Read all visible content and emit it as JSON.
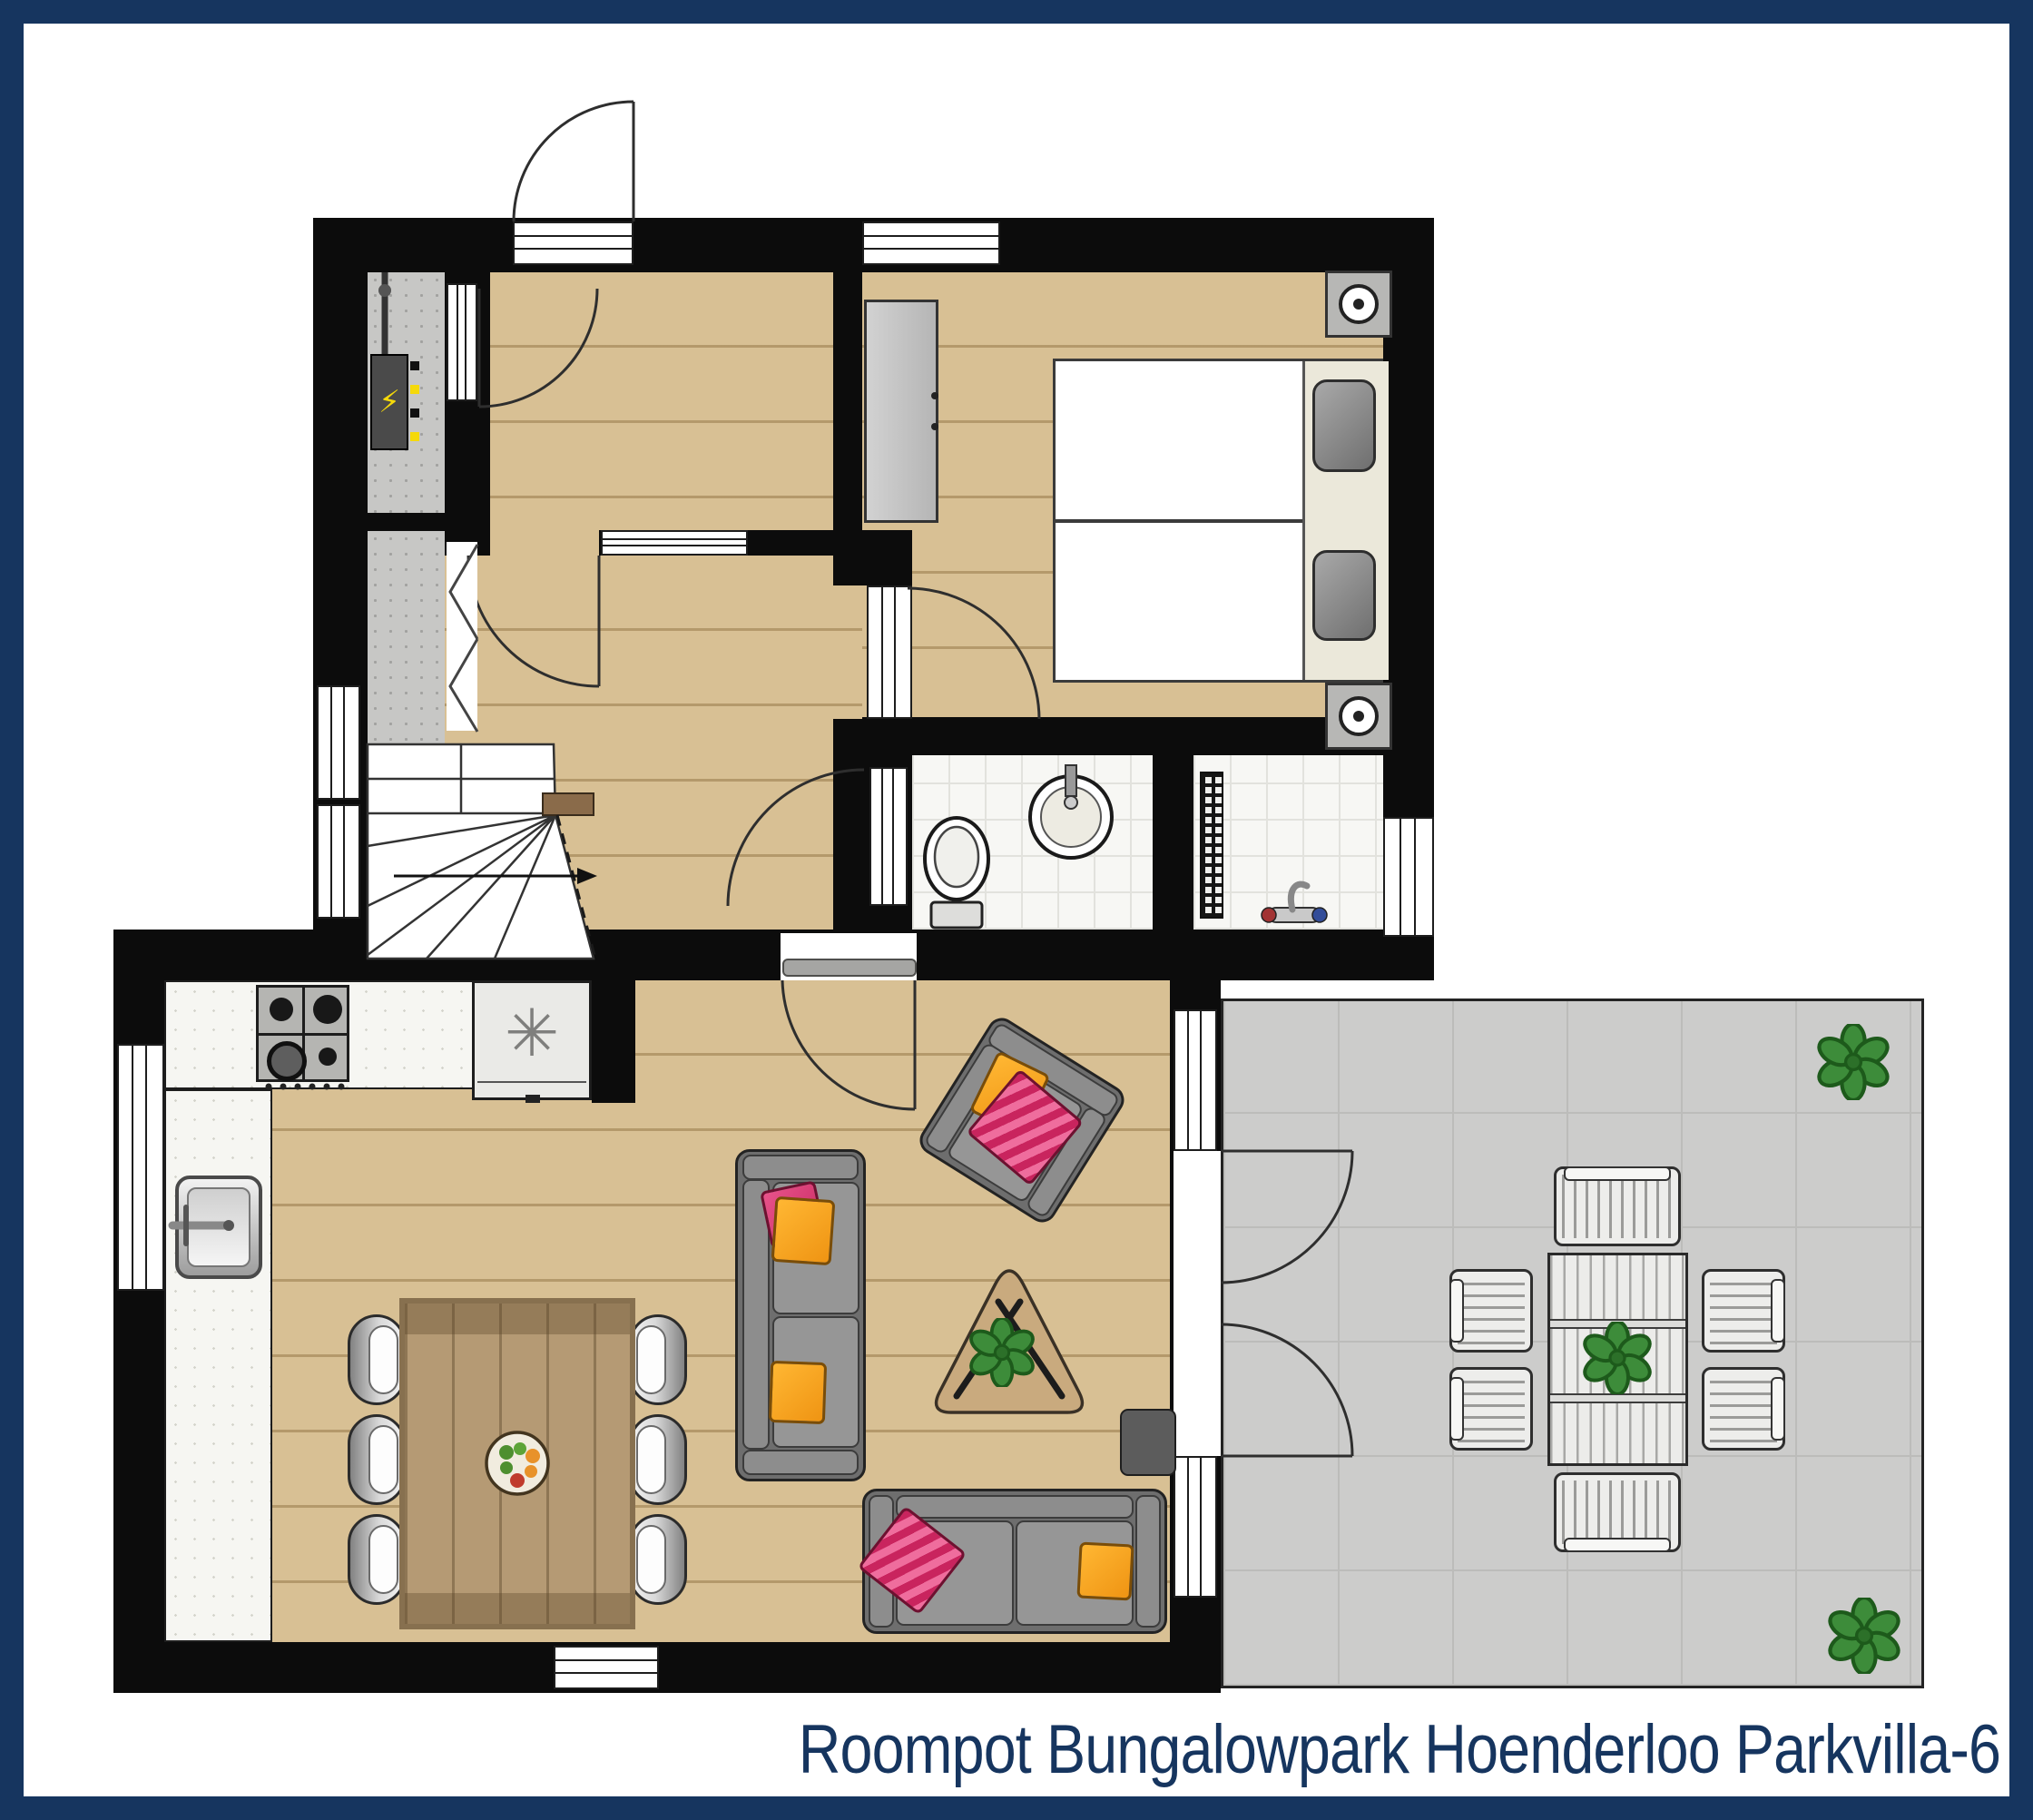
{
  "title": "Roompot Bungalowpark Hoenderloo Parkvilla-6",
  "icons": {
    "freezer": "✳",
    "power": "⚡"
  },
  "colors": {
    "frame_navy": "#16355F",
    "wall_black": "#0C0C0C",
    "wood_floor": "#D8C094",
    "terrace_gray": "#CCCCCB",
    "tile_white": "#F7F7F4",
    "accent_pink": "#C9245E",
    "accent_orange": "#F5A623",
    "plant_green": "#3D8C3A"
  },
  "rooms": [
    "entrance-hall",
    "hallway",
    "bedroom",
    "bathroom",
    "shower-room",
    "technical-closet",
    "storage-closet",
    "living-room",
    "kitchen",
    "terrace",
    "staircase"
  ],
  "furniture": [
    "twin-beds",
    "nightstands-with-lamps",
    "wardrobe",
    "toilet",
    "washbasin",
    "radiator",
    "shower-mixer",
    "gas-hob",
    "freezer",
    "kitchen-sink",
    "dining-table-6-chairs",
    "fruit-bowl",
    "sofa-large",
    "sofa-small",
    "armchair",
    "coffee-table",
    "side-table",
    "doormat",
    "terrace-table",
    "terrace-chairs",
    "plants"
  ]
}
